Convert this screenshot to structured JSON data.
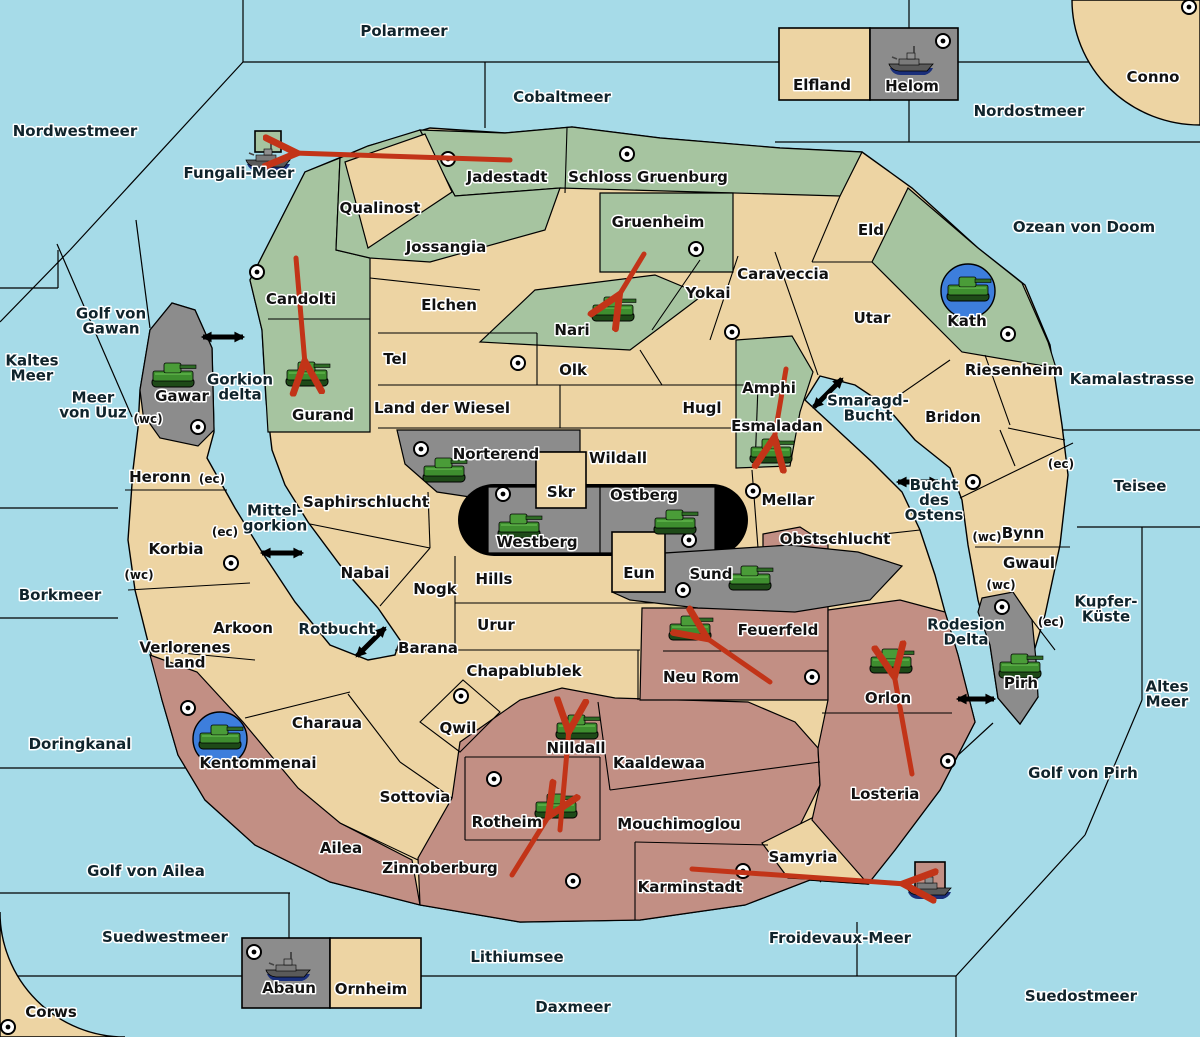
{
  "map_name": "Diplomacy-style strategy map (German territory names)",
  "colors": {
    "sea": "#A6DBE8",
    "land_neutral": "#EDD4A3",
    "land_green": "#A6C4A0",
    "land_red": "#C28F84",
    "land_gray": "#8C8C8C",
    "border": "#000000",
    "order_arrow_red": "#C23418",
    "crossing_arrow_black": "#000000",
    "unit_halo_blue": "#3D7EDC",
    "supply_center_fill": "#FFFFFF"
  },
  "sea_labels": [
    {
      "name": "Polarmeer",
      "x": 404,
      "y": 36,
      "lines": [
        "Polarmeer"
      ]
    },
    {
      "name": "Cobaltmeer",
      "x": 562,
      "y": 102,
      "lines": [
        "Cobaltmeer"
      ]
    },
    {
      "name": "Nordwestmeer",
      "x": 75,
      "y": 136,
      "lines": [
        "Nordwestmeer"
      ]
    },
    {
      "name": "Nordostmeer",
      "x": 1029,
      "y": 116,
      "lines": [
        "Nordostmeer"
      ]
    },
    {
      "name": "Ozean von Doom",
      "x": 1084,
      "y": 232,
      "lines": [
        "Ozean von Doom"
      ]
    },
    {
      "name": "Fungali-Meer",
      "x": 239,
      "y": 178,
      "lines": [
        "Fungali-Meer"
      ]
    },
    {
      "name": "Kaltes Meer",
      "x": 32,
      "y": 373,
      "lines": [
        "Kaltes",
        "Meer"
      ]
    },
    {
      "name": "Golf von Gawan",
      "x": 111,
      "y": 326,
      "lines": [
        "Golf von",
        "Gawan"
      ]
    },
    {
      "name": "Meer von Uuz",
      "x": 93,
      "y": 410,
      "lines": [
        "Meer",
        "von Uuz"
      ]
    },
    {
      "name": "Kamalastrasse",
      "x": 1132,
      "y": 384,
      "lines": [
        "Kamalastrasse"
      ]
    },
    {
      "name": "Teisee",
      "x": 1140,
      "y": 491,
      "lines": [
        "Teisee"
      ]
    },
    {
      "name": "Borkmeer",
      "x": 60,
      "y": 600,
      "lines": [
        "Borkmeer"
      ]
    },
    {
      "name": "Kupfer-Küste",
      "x": 1106,
      "y": 614,
      "lines": [
        "Kupfer-",
        "Küste"
      ]
    },
    {
      "name": "Altes Meer",
      "x": 1167,
      "y": 699,
      "lines": [
        "Altes",
        "Meer"
      ]
    },
    {
      "name": "Doringkanal",
      "x": 80,
      "y": 749,
      "lines": [
        "Doringkanal"
      ]
    },
    {
      "name": "Golf von Ailea",
      "x": 146,
      "y": 876,
      "lines": [
        "Golf von Ailea"
      ]
    },
    {
      "name": "Golf von Pirh",
      "x": 1083,
      "y": 778,
      "lines": [
        "Golf von Pirh"
      ]
    },
    {
      "name": "Suedwestmeer",
      "x": 165,
      "y": 942,
      "lines": [
        "Suedwestmeer"
      ]
    },
    {
      "name": "Froidevaux-Meer",
      "x": 840,
      "y": 943,
      "lines": [
        "Froidevaux-Meer"
      ]
    },
    {
      "name": "Lithiumsee",
      "x": 517,
      "y": 962,
      "lines": [
        "Lithiumsee"
      ]
    },
    {
      "name": "Daxmeer",
      "x": 573,
      "y": 1012,
      "lines": [
        "Daxmeer"
      ]
    },
    {
      "name": "Suedostmeer",
      "x": 1081,
      "y": 1001,
      "lines": [
        "Suedostmeer"
      ]
    },
    {
      "name": "Gorkion delta",
      "x": 240,
      "y": 392,
      "lines": [
        "Gorkion",
        "delta"
      ]
    },
    {
      "name": "Mittel-gorkion",
      "x": 275,
      "y": 523,
      "lines": [
        "Mittel-",
        "gorkion"
      ]
    },
    {
      "name": "Rotbucht",
      "x": 337,
      "y": 634,
      "lines": [
        "Rotbucht"
      ]
    },
    {
      "name": "Smaragd-Bucht",
      "x": 868,
      "y": 413,
      "lines": [
        "Smaragd-",
        "Bucht"
      ]
    },
    {
      "name": "Bucht des Ostens",
      "x": 934,
      "y": 505,
      "lines": [
        "Bucht",
        "des",
        "Ostens"
      ]
    },
    {
      "name": "Rodesion Delta",
      "x": 966,
      "y": 637,
      "lines": [
        "Rodesion",
        "Delta"
      ]
    }
  ],
  "territories": [
    {
      "name": "Jadestadt",
      "x": 507,
      "y": 182,
      "color": "green",
      "supply_center": {
        "x": 448,
        "y": 159
      }
    },
    {
      "name": "Schloss Gruenburg",
      "x": 648,
      "y": 182,
      "color": "green",
      "supply_center": {
        "x": 627,
        "y": 154
      }
    },
    {
      "name": "Elfland",
      "x": 822,
      "y": 90,
      "color": "land",
      "supply_center": null
    },
    {
      "name": "Helom",
      "x": 912,
      "y": 91,
      "color": "gray",
      "supply_center": {
        "x": 943,
        "y": 41
      }
    },
    {
      "name": "Conno",
      "x": 1153,
      "y": 82,
      "color": "land",
      "supply_center": {
        "x": 1189,
        "y": 7
      }
    },
    {
      "name": "Qualinost",
      "x": 380,
      "y": 213,
      "color": "land",
      "supply_center": null
    },
    {
      "name": "Jossangia",
      "x": 446,
      "y": 252,
      "color": "green",
      "supply_center": null
    },
    {
      "name": "Gruenheim",
      "x": 658,
      "y": 227,
      "color": "green",
      "supply_center": {
        "x": 696,
        "y": 249
      }
    },
    {
      "name": "Eld",
      "x": 871,
      "y": 235,
      "color": "land",
      "supply_center": null
    },
    {
      "name": "Candolti",
      "x": 301,
      "y": 304,
      "color": "green",
      "supply_center": {
        "x": 257,
        "y": 272
      }
    },
    {
      "name": "Elchen",
      "x": 449,
      "y": 310,
      "color": "land",
      "supply_center": null
    },
    {
      "name": "Nari",
      "x": 572,
      "y": 335,
      "color": "green",
      "supply_center": null
    },
    {
      "name": "Yokai",
      "x": 708,
      "y": 298,
      "color": "land",
      "supply_center": {
        "x": 732,
        "y": 332
      }
    },
    {
      "name": "Caraveccia",
      "x": 783,
      "y": 279,
      "color": "land",
      "supply_center": null
    },
    {
      "name": "Utar",
      "x": 872,
      "y": 323,
      "color": "land",
      "supply_center": null
    },
    {
      "name": "Kath",
      "x": 967,
      "y": 326,
      "color": "green",
      "supply_center": {
        "x": 1008,
        "y": 334
      }
    },
    {
      "name": "Tel",
      "x": 395,
      "y": 364,
      "color": "land",
      "supply_center": {
        "x": 518,
        "y": 363
      }
    },
    {
      "name": "Olk",
      "x": 573,
      "y": 375,
      "color": "land",
      "supply_center": null
    },
    {
      "name": "Riesenheim",
      "x": 1014,
      "y": 375,
      "color": "land",
      "supply_center": null
    },
    {
      "name": "Gawar",
      "x": 182,
      "y": 401,
      "color": "gray",
      "supply_center": {
        "x": 198,
        "y": 427
      }
    },
    {
      "name": "Gurand",
      "x": 323,
      "y": 420,
      "color": "green",
      "supply_center": null
    },
    {
      "name": "Amphi",
      "x": 769,
      "y": 393,
      "color": "green",
      "supply_center": null
    },
    {
      "name": "Esmaladan",
      "x": 777,
      "y": 431,
      "color": "green",
      "supply_center": null
    },
    {
      "name": "Land der Wiesel",
      "x": 442,
      "y": 413,
      "color": "land",
      "supply_center": null
    },
    {
      "name": "Hugl",
      "x": 702,
      "y": 413,
      "color": "land",
      "supply_center": null
    },
    {
      "name": "Bridon",
      "x": 953,
      "y": 422,
      "color": "land",
      "supply_center": null
    },
    {
      "name": "Norterend",
      "x": 496,
      "y": 459,
      "color": "gray",
      "supply_center": {
        "x": 421,
        "y": 449
      }
    },
    {
      "name": "Wildall",
      "x": 618,
      "y": 463,
      "color": "land",
      "supply_center": null
    },
    {
      "name": "Heronn",
      "x": 160,
      "y": 482,
      "color": "land",
      "supply_center": null
    },
    {
      "name": "Skr",
      "x": 561,
      "y": 497,
      "color": "land",
      "supply_center": null
    },
    {
      "name": "Ostberg",
      "x": 644,
      "y": 500,
      "color": "gray",
      "supply_center": {
        "x": 689,
        "y": 540
      }
    },
    {
      "name": "Westberg",
      "x": 537,
      "y": 547,
      "color": "gray",
      "supply_center": {
        "x": 503,
        "y": 494
      }
    },
    {
      "name": "Mellar",
      "x": 788,
      "y": 505,
      "color": "land",
      "supply_center": {
        "x": 753,
        "y": 491
      }
    },
    {
      "name": "Saphirschlucht",
      "x": 366,
      "y": 507,
      "color": "land",
      "supply_center": null
    },
    {
      "name": "Bynn",
      "x": 1023,
      "y": 538,
      "color": "land",
      "supply_center": {
        "x": 973,
        "y": 482
      }
    },
    {
      "name": "Obstschlucht",
      "x": 835,
      "y": 544,
      "color": "land",
      "supply_center": null
    },
    {
      "name": "Korbia",
      "x": 176,
      "y": 554,
      "color": "land",
      "supply_center": {
        "x": 231,
        "y": 563
      }
    },
    {
      "name": "Gwaul",
      "x": 1029,
      "y": 568,
      "color": "land",
      "supply_center": null
    },
    {
      "name": "Nabai",
      "x": 365,
      "y": 578,
      "color": "land",
      "supply_center": null
    },
    {
      "name": "Hills",
      "x": 494,
      "y": 584,
      "color": "land",
      "supply_center": null
    },
    {
      "name": "Eun",
      "x": 639,
      "y": 578,
      "color": "land",
      "supply_center": null
    },
    {
      "name": "Sund",
      "x": 711,
      "y": 579,
      "color": "gray",
      "supply_center": {
        "x": 683,
        "y": 590
      }
    },
    {
      "name": "Nogk",
      "x": 435,
      "y": 594,
      "color": "land",
      "supply_center": null
    },
    {
      "name": "Urur",
      "x": 496,
      "y": 630,
      "color": "land",
      "supply_center": null
    },
    {
      "name": "Arkoon",
      "x": 243,
      "y": 633,
      "color": "land",
      "supply_center": null
    },
    {
      "name": "Feuerfeld",
      "x": 778,
      "y": 635,
      "color": "red",
      "supply_center": null
    },
    {
      "name": "Neu Rom",
      "x": 701,
      "y": 682,
      "color": "red",
      "supply_center": {
        "x": 812,
        "y": 677
      }
    },
    {
      "name": "Barana",
      "x": 428,
      "y": 653,
      "color": "land",
      "supply_center": null
    },
    {
      "name": "Verlorenes Land",
      "x": 185,
      "y": 660,
      "color": "land",
      "supply_center": null,
      "lines": [
        "Verlorenes",
        "Land"
      ]
    },
    {
      "name": "Chapablublek",
      "x": 524,
      "y": 676,
      "color": "land",
      "supply_center": null
    },
    {
      "name": "Orlon",
      "x": 888,
      "y": 703,
      "color": "red",
      "supply_center": null
    },
    {
      "name": "Pirh",
      "x": 1021,
      "y": 688,
      "color": "gray",
      "supply_center": {
        "x": 1002,
        "y": 607
      }
    },
    {
      "name": "Rodesion-Delta-area",
      "x": 0,
      "y": 0,
      "color": "sea",
      "supply_center": null,
      "lines": []
    },
    {
      "name": "Qwil",
      "x": 458,
      "y": 733,
      "color": "land",
      "supply_center": {
        "x": 461,
        "y": 696
      }
    },
    {
      "name": "Charaua",
      "x": 327,
      "y": 728,
      "color": "land",
      "supply_center": null
    },
    {
      "name": "Kentommenai",
      "x": 258,
      "y": 768,
      "color": "red",
      "supply_center": {
        "x": 188,
        "y": 708
      }
    },
    {
      "name": "Nilldall",
      "x": 576,
      "y": 753,
      "color": "red",
      "supply_center": null
    },
    {
      "name": "Kaaldewaa",
      "x": 659,
      "y": 768,
      "color": "red",
      "supply_center": null
    },
    {
      "name": "Sottovia",
      "x": 415,
      "y": 802,
      "color": "land",
      "supply_center": null
    },
    {
      "name": "Rotheim",
      "x": 507,
      "y": 827,
      "color": "red",
      "supply_center": {
        "x": 494,
        "y": 779
      }
    },
    {
      "name": "Mouchimoglou",
      "x": 679,
      "y": 829,
      "color": "red",
      "supply_center": null
    },
    {
      "name": "Losteria",
      "x": 885,
      "y": 799,
      "color": "red",
      "supply_center": {
        "x": 948,
        "y": 761
      }
    },
    {
      "name": "Ailea",
      "x": 341,
      "y": 853,
      "color": "red",
      "supply_center": null
    },
    {
      "name": "Zinnoberburg",
      "x": 440,
      "y": 873,
      "color": "red",
      "supply_center": {
        "x": 573,
        "y": 881
      }
    },
    {
      "name": "Samyria",
      "x": 803,
      "y": 862,
      "color": "land",
      "supply_center": null
    },
    {
      "name": "Karminstadt",
      "x": 690,
      "y": 892,
      "color": "red",
      "supply_center": {
        "x": 743,
        "y": 871
      }
    },
    {
      "name": "Abaun",
      "x": 289,
      "y": 993,
      "color": "gray",
      "supply_center": {
        "x": 254,
        "y": 952
      }
    },
    {
      "name": "Ornheim",
      "x": 371,
      "y": 994,
      "color": "land",
      "supply_center": null
    },
    {
      "name": "Corws",
      "x": 51,
      "y": 1017,
      "color": "land",
      "supply_center": {
        "x": 8,
        "y": 1027
      }
    }
  ],
  "coast_tags": [
    {
      "text": "(wc)",
      "territory": "Heronn",
      "x": 148,
      "y": 423
    },
    {
      "text": "(ec)",
      "territory": "Heronn",
      "x": 212,
      "y": 483
    },
    {
      "text": "(ec)",
      "territory": "Korbia",
      "x": 225,
      "y": 536
    },
    {
      "text": "(wc)",
      "territory": "Korbia",
      "x": 139,
      "y": 579
    },
    {
      "text": "(ec)",
      "territory": "Bynn",
      "x": 1061,
      "y": 468
    },
    {
      "text": "(wc)",
      "territory": "Bynn",
      "x": 987,
      "y": 541
    },
    {
      "text": "(wc)",
      "territory": "Gwaul",
      "x": 1001,
      "y": 589
    },
    {
      "text": "(ec)",
      "territory": "Gwaul",
      "x": 1051,
      "y": 626
    }
  ],
  "units": [
    {
      "type": "tank",
      "territory": "Gawar",
      "x": 173,
      "y": 375,
      "circled": false
    },
    {
      "type": "tank",
      "territory": "Gurand",
      "x": 307,
      "y": 374,
      "circled": false
    },
    {
      "type": "tank",
      "territory": "Nari",
      "x": 613,
      "y": 309,
      "circled": false
    },
    {
      "type": "tank",
      "territory": "Esmaladan",
      "x": 771,
      "y": 451,
      "circled": false
    },
    {
      "type": "tank",
      "territory": "Norterend",
      "x": 444,
      "y": 470,
      "circled": false
    },
    {
      "type": "tank",
      "territory": "Westberg",
      "x": 519,
      "y": 526,
      "circled": false
    },
    {
      "type": "tank",
      "territory": "Ostberg",
      "x": 675,
      "y": 522,
      "circled": false
    },
    {
      "type": "tank",
      "territory": "Sund",
      "x": 750,
      "y": 578,
      "circled": false
    },
    {
      "type": "tank",
      "territory": "Kath",
      "x": 968,
      "y": 289,
      "circled": true
    },
    {
      "type": "tank",
      "territory": "Feuerfeld",
      "x": 690,
      "y": 628,
      "circled": false
    },
    {
      "type": "tank",
      "territory": "Orlon",
      "x": 891,
      "y": 661,
      "circled": false
    },
    {
      "type": "tank",
      "territory": "Pirh",
      "x": 1020,
      "y": 666,
      "circled": false
    },
    {
      "type": "tank",
      "territory": "Kentommenai",
      "x": 220,
      "y": 737,
      "circled": true
    },
    {
      "type": "tank",
      "territory": "Nilldall",
      "x": 577,
      "y": 727,
      "circled": false
    },
    {
      "type": "tank",
      "territory": "Rotheim",
      "x": 556,
      "y": 806,
      "circled": false
    },
    {
      "type": "ship",
      "territory": "Fungali-Meer",
      "x": 268,
      "y": 158,
      "circled": false
    },
    {
      "type": "ship",
      "territory": "Helom",
      "x": 911,
      "y": 62,
      "circled": false
    },
    {
      "type": "ship",
      "territory": "Abaun",
      "x": 288,
      "y": 968,
      "circled": false
    },
    {
      "type": "ship",
      "territory": "Froidevaux-Meer",
      "x": 929,
      "y": 886,
      "circled": false
    }
  ],
  "move_arrows": [
    {
      "from": "Jadestadt",
      "to": "Fungali-Meer",
      "x1": 510,
      "y1": 160,
      "x2": 294,
      "y2": 153
    },
    {
      "from": "Candolti",
      "to": "Gurand",
      "x1": 296,
      "y1": 258,
      "x2": 305,
      "y2": 364
    },
    {
      "from": "Gruenheim",
      "to": "Nari",
      "x1": 644,
      "y1": 254,
      "x2": 618,
      "y2": 297
    },
    {
      "from": "Amphi",
      "to": "Esmaladan",
      "x1": 786,
      "y1": 369,
      "x2": 774,
      "y2": 440
    },
    {
      "from": "Neu Rom",
      "to": "Feuerfeld",
      "x1": 770,
      "y1": 682,
      "x2": 705,
      "y2": 637
    },
    {
      "from": "Losteria",
      "to": "Orlon",
      "x1": 912,
      "y1": 774,
      "x2": 894,
      "y2": 674
    },
    {
      "from": "Zinnoberburg",
      "to": "Rotheim",
      "x1": 512,
      "y1": 875,
      "x2": 550,
      "y2": 814
    },
    {
      "from": "Rotheim",
      "to": "Nilldall",
      "x1": 560,
      "y1": 830,
      "x2": 569,
      "y2": 729
    },
    {
      "from": "Karminstadt",
      "to": "Froidevaux-Meer",
      "x1": 692,
      "y1": 869,
      "x2": 906,
      "y2": 884
    }
  ],
  "crossing_arrows": [
    {
      "at": "Gorkion delta",
      "x1": 203,
      "y1": 337,
      "x2": 243,
      "y2": 337
    },
    {
      "at": "Mittel-gorkion",
      "x1": 262,
      "y1": 553,
      "x2": 302,
      "y2": 553
    },
    {
      "at": "Rotbucht",
      "x1": 357,
      "y1": 656,
      "x2": 385,
      "y2": 628
    },
    {
      "at": "Smaragd-Bucht",
      "x1": 814,
      "y1": 407,
      "x2": 842,
      "y2": 379
    },
    {
      "at": "Bucht des Ostens",
      "x1": 898,
      "y1": 482,
      "x2": 938,
      "y2": 482
    },
    {
      "at": "Rodesion Delta",
      "x1": 958,
      "y1": 699,
      "x2": 994,
      "y2": 699
    }
  ]
}
